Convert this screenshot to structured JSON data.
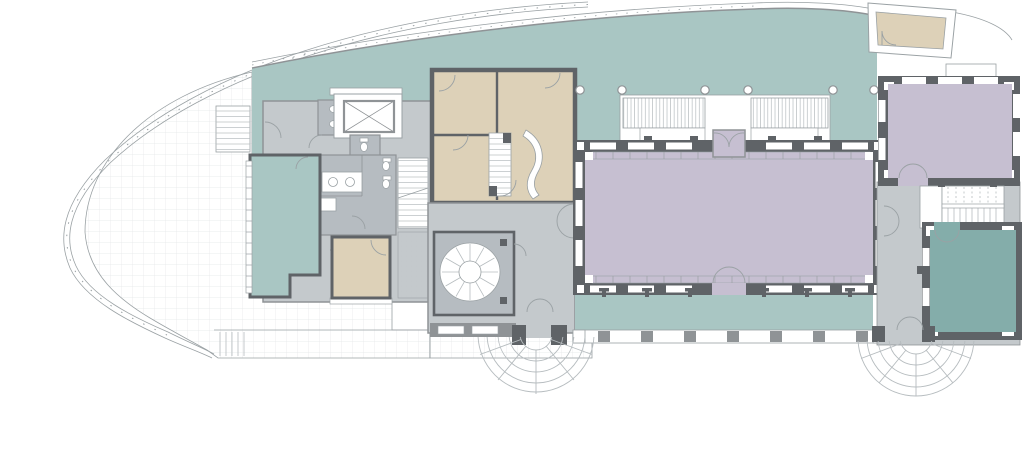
{
  "document": {
    "kind": "architectural-floor-plan",
    "description": "Ground floor plan of a long curved-prow building: west outdoor terrace inside a curved canopy, large teal open deck, central lavender great hall with north stepped terrace and south colonnaded veranda, service core with WCs and elevator, spiral stair lobby with fan entrance steps, east wing with lavender room, switchback stair, dark-teal corner room and second fan entrance."
  },
  "palette": {
    "paper": "#ffffff",
    "teal": "#a9c6c3",
    "tealDark": "#84adaa",
    "lavender": "#c6bfd1",
    "tan": "#ddd1b8",
    "floorGray": "#c4c9cc",
    "floorGrayDark": "#b6bcc1",
    "wallDark": "#5f6367",
    "wallMid": "#8f9396",
    "lineGray": "#9aa1a4",
    "stepGray": "#b6bcbf",
    "gridLine": "#e4e7e8"
  },
  "areas": [
    {
      "id": "west-terrace",
      "type": "outdoor tiled terrace",
      "fill": "paper"
    },
    {
      "id": "open-deck",
      "type": "open interior deck",
      "fill": "teal"
    },
    {
      "id": "left-lounge",
      "type": "glazed lounge room",
      "fill": "teal"
    },
    {
      "id": "service-core",
      "type": "WC / elevator core",
      "fill": "floorGray"
    },
    {
      "id": "sw-office",
      "type": "small room",
      "fill": "tan"
    },
    {
      "id": "office-suite",
      "type": "office suite with curved counter",
      "fill": "tan"
    },
    {
      "id": "lobby",
      "type": "entrance lobby with spiral stair",
      "fill": "floorGray"
    },
    {
      "id": "great-hall",
      "type": "great hall",
      "fill": "lavender"
    },
    {
      "id": "north-terrace",
      "type": "stepped terrace / seating",
      "fill": "paper"
    },
    {
      "id": "south-veranda",
      "type": "colonnaded veranda",
      "fill": "teal"
    },
    {
      "id": "east-room",
      "type": "east lavender room",
      "fill": "lavender"
    },
    {
      "id": "east-stair-hall",
      "type": "stair hall",
      "fill": "floorGray"
    },
    {
      "id": "corner-room",
      "type": "dark teal corner room",
      "fill": "tealDark"
    },
    {
      "id": "ne-porch-room",
      "type": "small angled porch room",
      "fill": "tan"
    }
  ],
  "features": {
    "columns_north_row": 6,
    "fan_step_entrances": 2,
    "spiral_stair": 1,
    "switchback_stair": 1,
    "straight_stairs": 3,
    "elevator": 1,
    "wc_fixtures": "toilets and basins in service core"
  }
}
